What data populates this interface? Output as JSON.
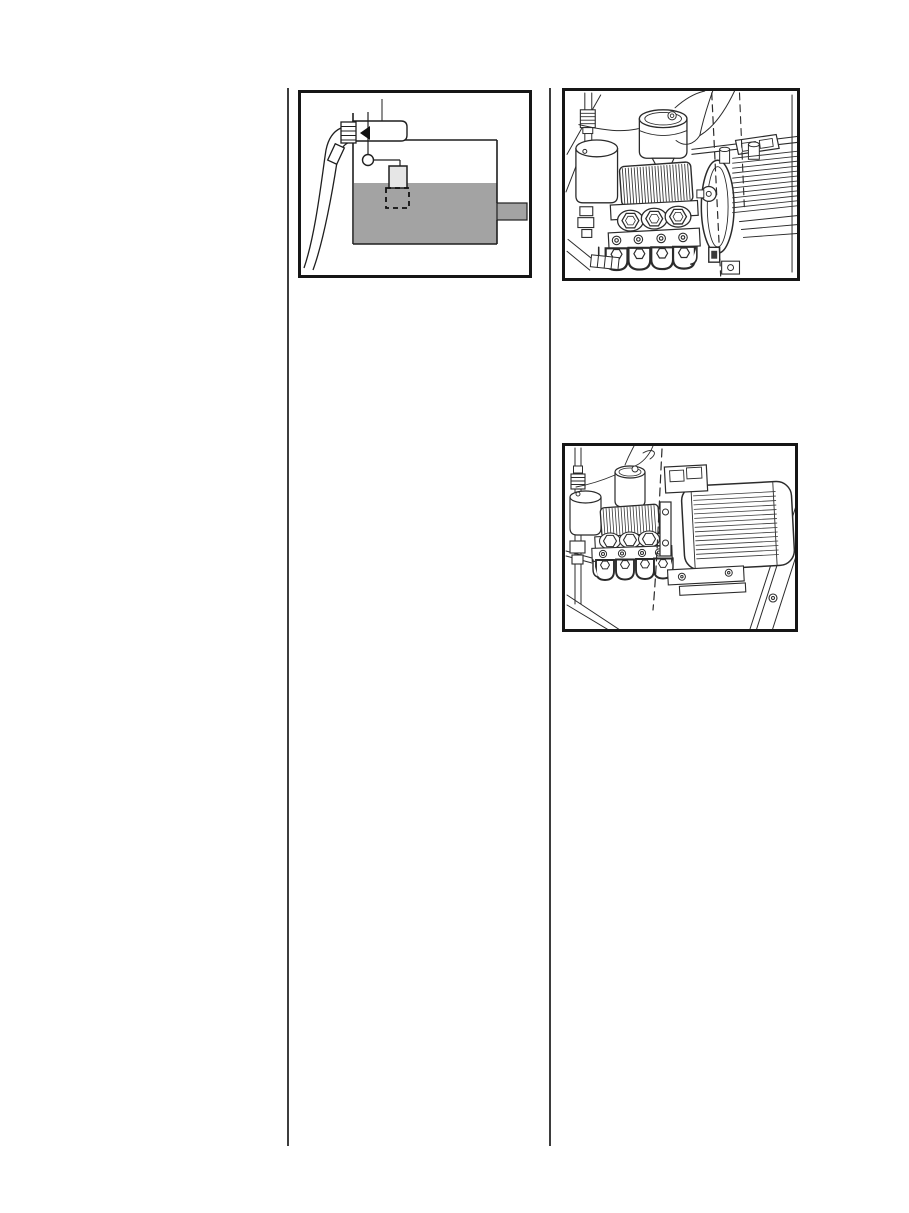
{
  "page": {
    "background": "#ffffff",
    "divider_color": "#3d3d3d"
  },
  "colors": {
    "line": "#2b2b2b",
    "box_border": "#161616",
    "liquid_gray": "#a3a3a3",
    "pipe_gray": "#a3a3a3",
    "filter_gray": "#e6e6e6",
    "arrow_black": "#111111"
  },
  "figures": [
    {
      "label": "water-tank-with-float-valve-and-suction-hose-diagram",
      "parts": [
        "suction-hose",
        "threaded-fitting",
        "float-valve-housing",
        "float-arrow",
        "float-pivot",
        "filter-box",
        "tank-liquid",
        "outlet-pipe"
      ]
    },
    {
      "label": "high-pressure-pump-close-up-illustration",
      "parts": [
        "oil-reservoir",
        "canister",
        "finned-crankcase",
        "hex-plugs",
        "valve-ports",
        "manifold-lobes",
        "flange-disc",
        "motor-fins",
        "dashed-centerlines",
        "frame-tubes"
      ]
    },
    {
      "label": "pump-with-electric-motor-illustration",
      "parts": [
        "oil-reservoir",
        "canister",
        "finned-crankcase",
        "hex-plugs",
        "manifold-lobes",
        "electric-motor",
        "terminal-box",
        "motor-feet",
        "dashed-centerline",
        "frame-tubes"
      ]
    }
  ]
}
